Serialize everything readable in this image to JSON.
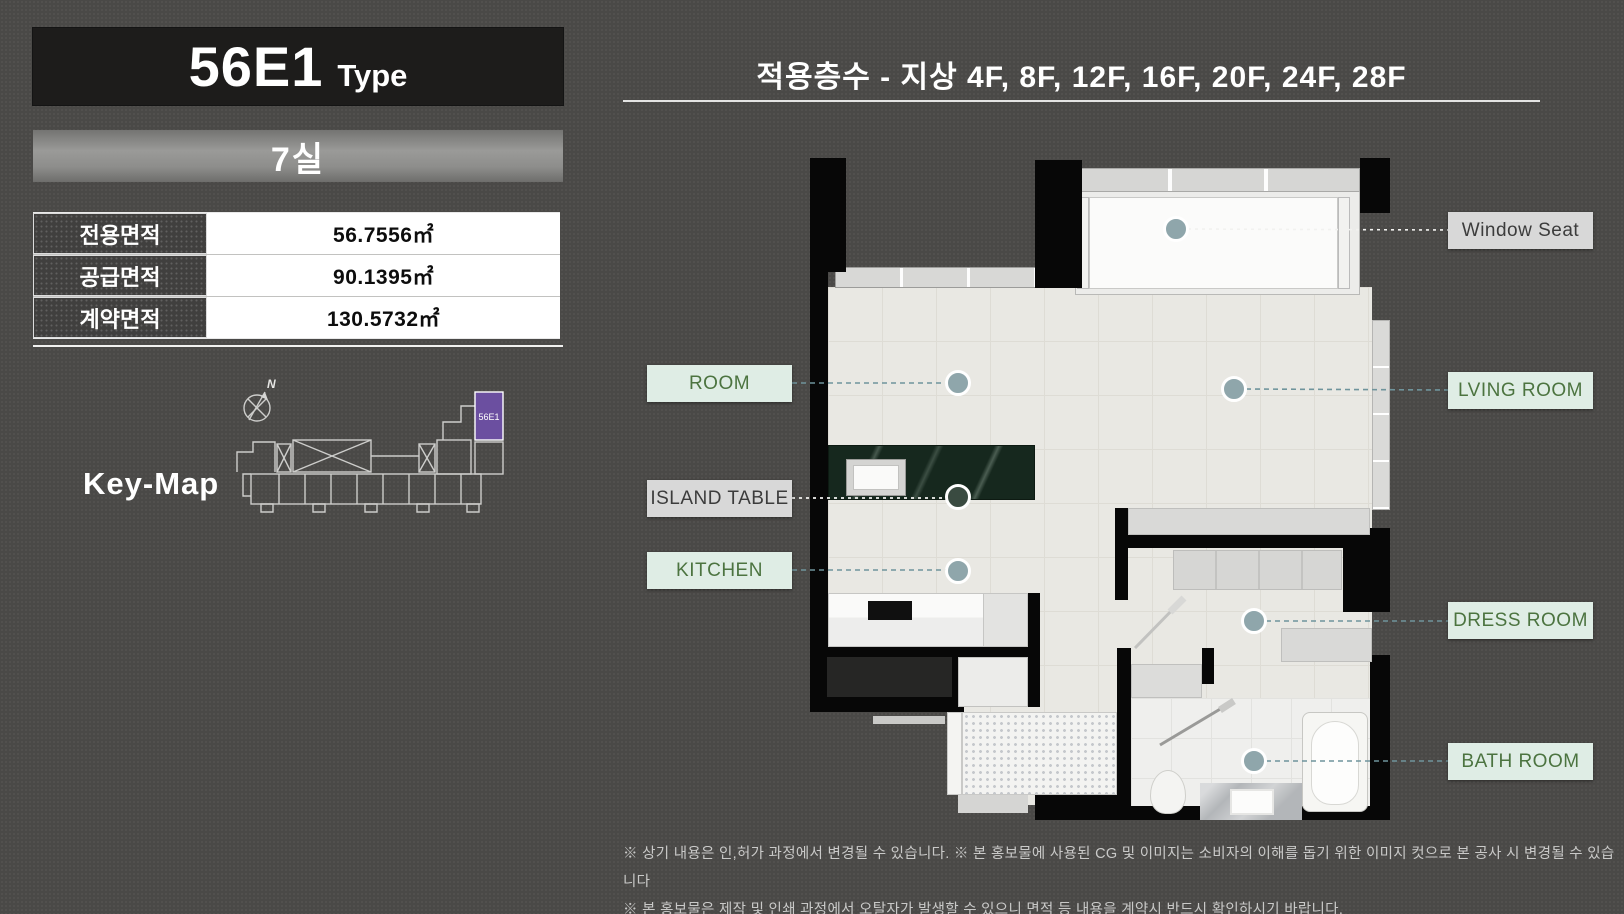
{
  "left_panel": {
    "type_code": "56E1",
    "type_word": "Type",
    "unit_count": "7실",
    "area_table": {
      "rows": [
        {
          "label": "전용면적",
          "value": "56.7556㎡"
        },
        {
          "label": "공급면적",
          "value": "90.1395㎡"
        },
        {
          "label": "계약면적",
          "value": "130.5732㎡"
        }
      ]
    },
    "key_map": {
      "title": "Key-Map",
      "compass_label": "N",
      "highlight_unit": "56E1"
    }
  },
  "right_panel": {
    "floors_header": "적용층수 - 지상 4F, 8F, 12F, 16F, 20F, 24F, 28F",
    "labels": {
      "window_seat": "Window Seat",
      "room": "ROOM",
      "living_room": "LVING ROOM",
      "island_table": "ISLAND TABLE",
      "kitchen": "KITCHEN",
      "dress_room": "DRESS ROOM",
      "bath_room": "BATH ROOM"
    },
    "disclaimer": [
      "※ 상기 내용은 인,허가 과정에서 변경될 수 있습니다. ※ 본 홍보물에 사용된 CG 및 이미지는 소비자의 이해를 돕기 위한 이미지 컷으로 본 공사 시 변경될 수 있습니다",
      "※ 본 홍보물은 제작 및 인쇄 과정에서 오탈자가 발생할 수 있으니 면적 등 내용을 계약시 반드시 확인하시기 바랍니다."
    ]
  },
  "colors": {
    "accent_mint": "#dfede5",
    "label_green": "#4c7440",
    "label_gray": "#d8d8d8",
    "highlight_purple": "#6b4fa0",
    "island_marble_green": "#16281e",
    "marker_dot": "#8fa6ab"
  }
}
